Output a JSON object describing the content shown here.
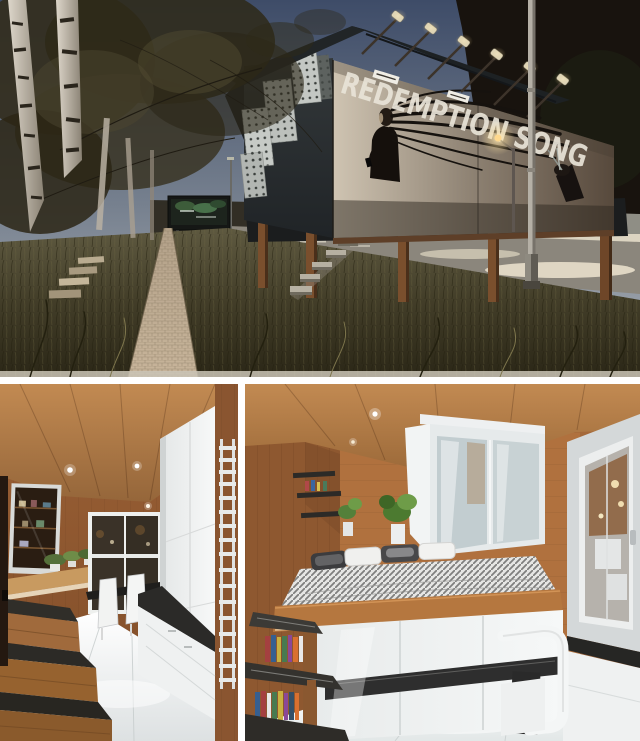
{
  "collage": {
    "billboard_title": "REDEMPTION SONG",
    "photos": [
      {
        "name": "exterior-billboard-house-dusk"
      },
      {
        "name": "interior-kitchen-hallway"
      },
      {
        "name": "interior-bedroom-platform"
      }
    ],
    "colors": {
      "frame_white": "#ffffff",
      "sky_top": "#3e4c68",
      "sky_horizon": "#adb2b8",
      "mountain": "#18130e",
      "house_body": "#2b2f32",
      "billboard_light": "#cfc4b2",
      "billboard_dark": "#57493c",
      "grass": "#4e4832",
      "brick_path": "#b5a287",
      "stilt_wood": "#7a4f2d",
      "lamp_glow": "#ffe9b0",
      "wood_light": "#c28a52",
      "wood_dark": "#7e4c28",
      "cabinet_white": "#f1f3f3",
      "tread_dark": "#312f2a"
    }
  }
}
